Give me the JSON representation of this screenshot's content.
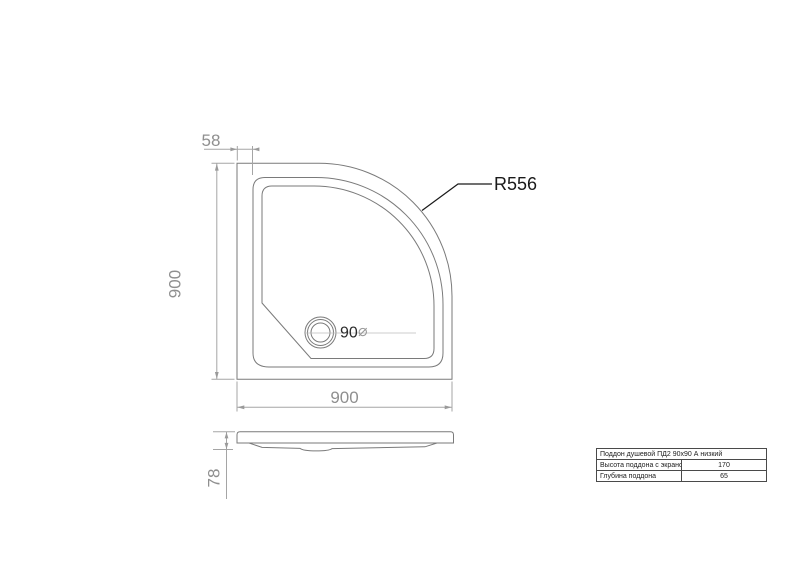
{
  "drawing": {
    "top_view": {
      "rim_dim": "58",
      "height_dim": "900",
      "width_dim": "900",
      "radius_label": "R556",
      "drain_dim": "90",
      "diameter_symbol": "⌀"
    },
    "side_view": {
      "height_dim": "78"
    }
  },
  "spec_table": {
    "title": "Поддон душевой ПД2 90х90 А низкий",
    "rows": [
      {
        "label": "Высота поддона с экраном",
        "value": "170"
      },
      {
        "label": "Глубина поддона",
        "value": "65"
      }
    ]
  },
  "colors": {
    "contour": "#7a7a7a",
    "dimension_line": "#a5a5a5",
    "dimension_text": "#8f8f8f",
    "annotation": "#1a1a1a",
    "background": "#ffffff"
  }
}
